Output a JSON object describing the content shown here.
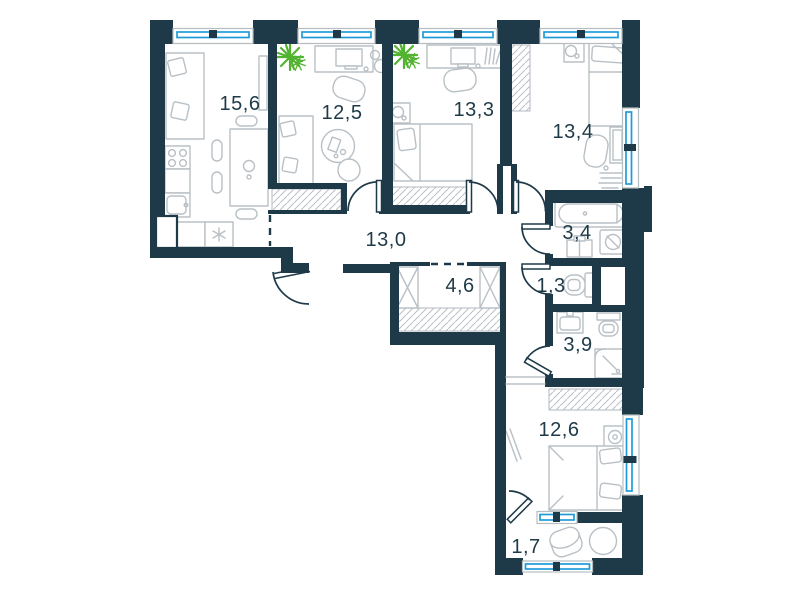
{
  "plan": {
    "type": "apartment-floor-plan",
    "rooms": [
      {
        "id": "living-kitchen",
        "area": "15,6"
      },
      {
        "id": "bedroom-office",
        "area": "12,5"
      },
      {
        "id": "bedroom-2",
        "area": "13,3"
      },
      {
        "id": "bedroom-3",
        "area": "13,4"
      },
      {
        "id": "corridor",
        "area": "13,0"
      },
      {
        "id": "bathroom",
        "area": "3,4"
      },
      {
        "id": "wc",
        "area": "1,3"
      },
      {
        "id": "wardrobe-hall",
        "area": "4,6"
      },
      {
        "id": "shower-room",
        "area": "3,9"
      },
      {
        "id": "bedroom-4",
        "area": "12,6"
      },
      {
        "id": "balcony",
        "area": "1,7"
      }
    ],
    "colors": {
      "wall": "#1e3a48",
      "window_glass": "#209bd8",
      "furniture_line": "#b9c0c5",
      "plant": "#52b330",
      "background": "#ffffff",
      "label_text": "#1e3a48"
    }
  }
}
